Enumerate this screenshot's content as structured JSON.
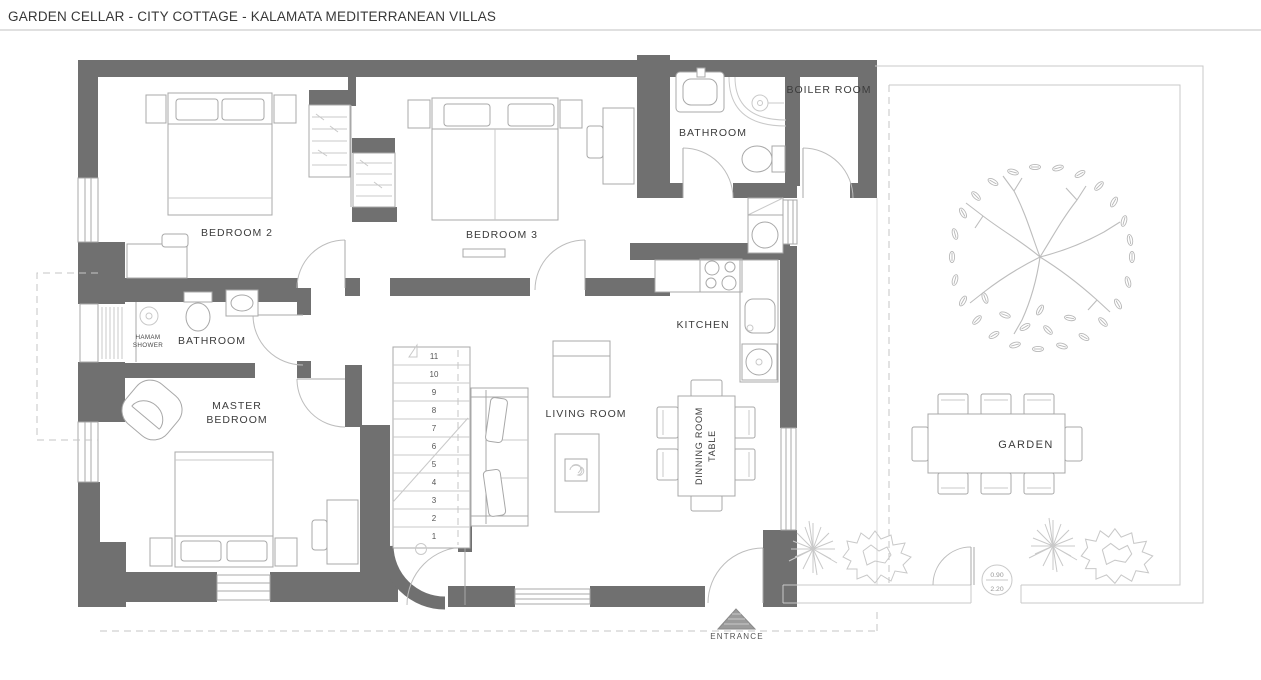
{
  "title": "GARDEN CELLAR - CITY COTTAGE - KALAMATA MEDITERRANEAN VILLAS",
  "colors": {
    "wall": "#707070",
    "linework": "#a8a8a8",
    "label_text": "#3c3c3c"
  },
  "rooms": {
    "bedroom2": "BEDROOM 2",
    "bedroom3": "BEDROOM 3",
    "bathroom_top": "BATHROOM",
    "boiler_room": "BOILER ROOM",
    "bathroom_mid": "BATHROOM",
    "hamam_line1": "HAMAM",
    "hamam_line2": "SHOWER",
    "master_line1": "MASTER",
    "master_line2": "BEDROOM",
    "living_room": "LIVING ROOM",
    "kitchen": "KITCHEN",
    "dining_line1": "DINNING ROOM",
    "dining_line2": "TABLE",
    "garden": "GARDEN"
  },
  "entrance_label": "ENTRANCE",
  "stairs": {
    "numbers": [
      "11",
      "10",
      "9",
      "8",
      "7",
      "6",
      "5",
      "4",
      "3",
      "2",
      "1"
    ]
  },
  "gate_tag": {
    "top": "0.90",
    "bottom": "2.20"
  }
}
